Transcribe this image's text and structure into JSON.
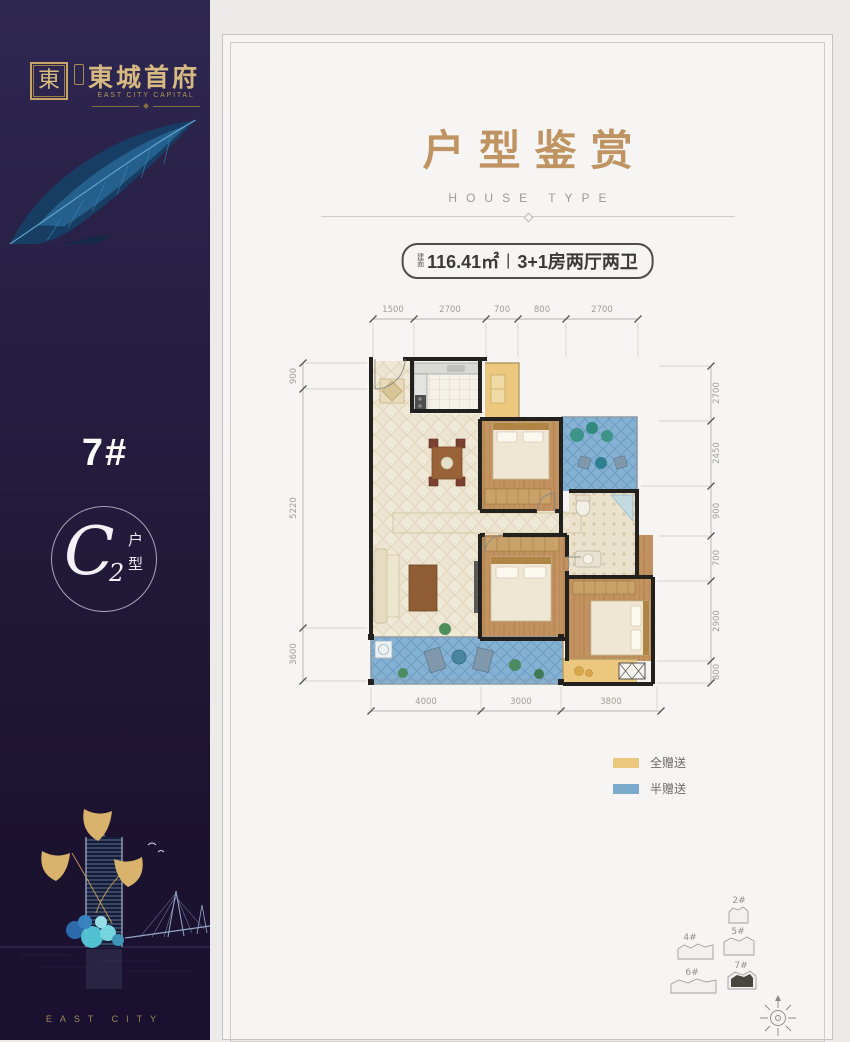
{
  "sidebar": {
    "seal_char": "東",
    "brand": "東城首府",
    "brand_en": "EAST CITY CAPITAL",
    "block_number": "7#",
    "unit_letter": "C",
    "unit_sub": "2",
    "unit_label_1": "户",
    "unit_label_2": "型",
    "footer_en": "EAST CITY"
  },
  "header": {
    "title": "户型鉴赏",
    "subtitle": "HOUSE TYPE"
  },
  "badge": {
    "prefix_1": "建",
    "prefix_2": "面",
    "area": "116.41㎡",
    "separator": "|",
    "layout": "3+1房两厅两卫"
  },
  "plan": {
    "dims_top": [
      "1500",
      "2700",
      "700",
      "800",
      "2700"
    ],
    "dims_left": [
      "900",
      "5220",
      "3600"
    ],
    "dims_right": [
      "2700",
      "2450",
      "900",
      "700",
      "2900",
      "800"
    ],
    "dims_bottom": [
      "4000",
      "3000",
      "3800"
    ]
  },
  "legend": {
    "full_label": "全赠送",
    "full_color": "#ecc87e",
    "half_label": "半赠送",
    "half_color": "#7aa9cc"
  },
  "sitemap": {
    "b2": "2#",
    "b4": "4#",
    "b5": "5#",
    "b6": "6#",
    "b7": "7#"
  },
  "colors": {
    "accent_gold": "#bf9362",
    "sidebar_bg": "#251d3f",
    "wall": "#23211d",
    "gift_full": "#ecc87e",
    "gift_half": "#7aa9cc"
  }
}
